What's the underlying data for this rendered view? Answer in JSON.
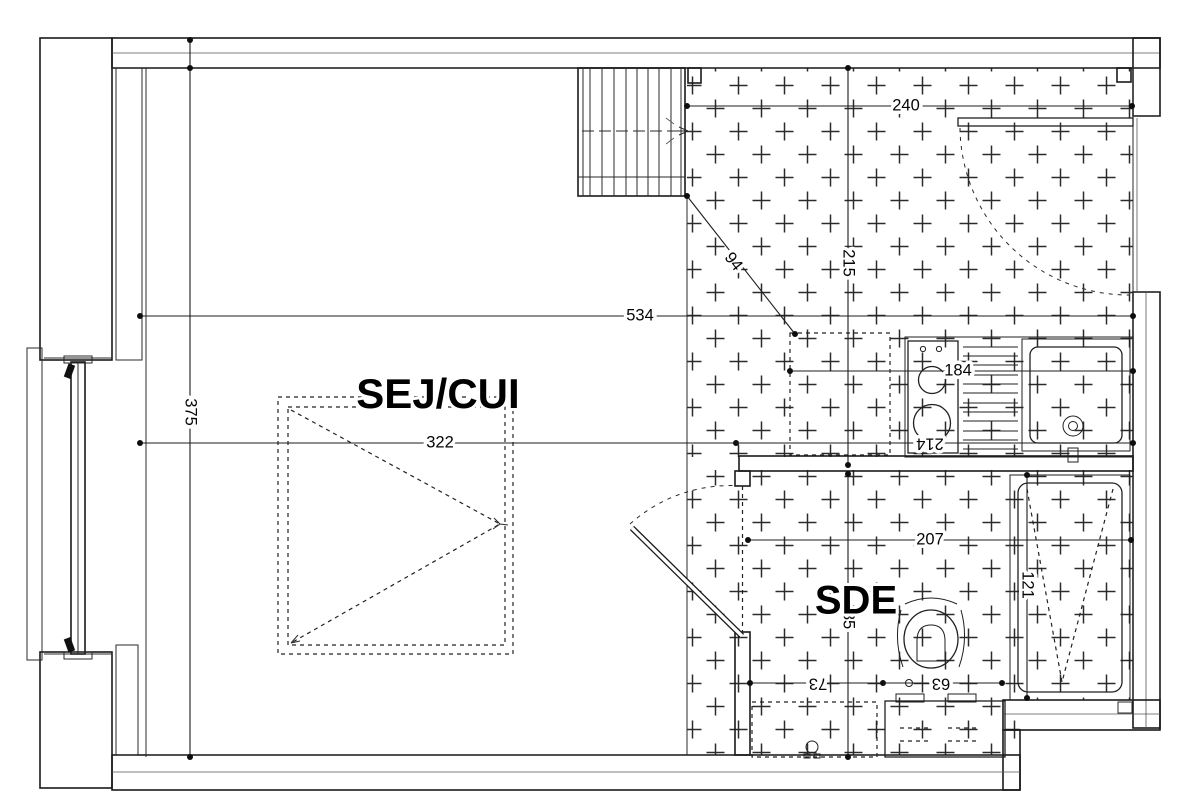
{
  "rooms": {
    "living_kitchen": "SEJ/CUI",
    "shower_room": "SDE"
  },
  "dimensions": {
    "entry_width": "240",
    "interior_width": "534",
    "entry_depth": "215",
    "stair_clearance": "94",
    "interior_depth": "375",
    "living_width": "322",
    "kitchen_width": "214",
    "counter_span": "184",
    "sde_width": "207",
    "shower_length": "121",
    "wc_zone_depth": "85",
    "wc_offset": "73",
    "wc_width": "63"
  },
  "fixtures": {
    "staircase": "staircase",
    "entrance_door": "entrance-door",
    "interior_door": "sde-door",
    "window": "window",
    "sofa_bed_reservation": "sofa-bed-reservation",
    "appliance_reservation": "appliance-reservation",
    "cooktop": "cooktop-2-burners",
    "drainer": "drainer-board",
    "sink": "kitchen-sink",
    "shower": "shower-tray",
    "toilet": "toilet",
    "washer_reservation": "washing-machine-reservation",
    "vanity": "vanity-unit"
  },
  "colors": {
    "line": "#1a1a1a",
    "background": "#ffffff"
  }
}
